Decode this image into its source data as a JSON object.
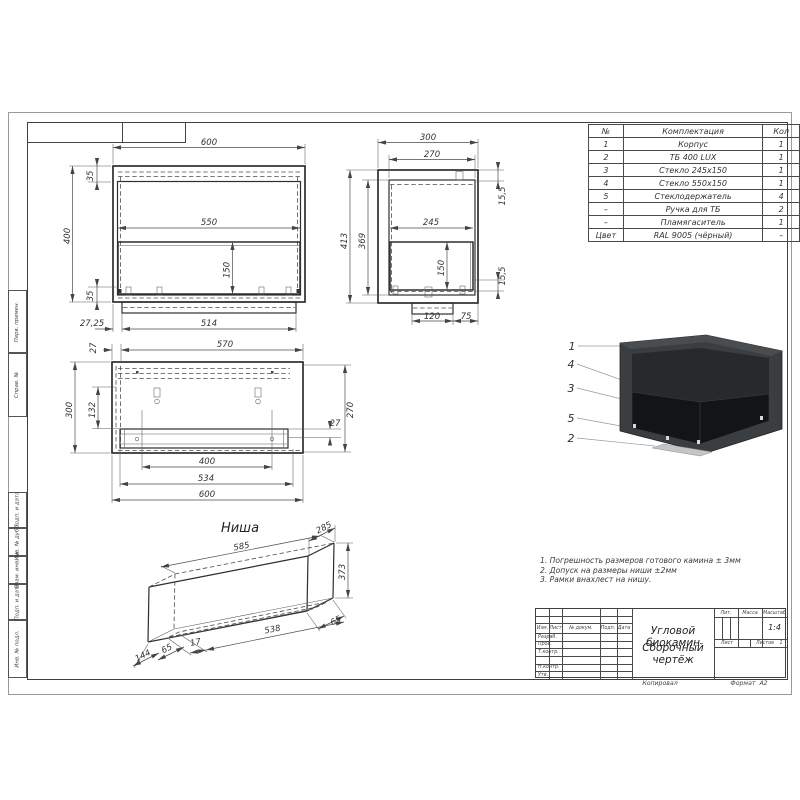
{
  "views": {
    "front": {
      "dim_width": "600",
      "dim_height": "400",
      "dim_top_inset": "35",
      "dim_bottom_inset": "35",
      "dim_glass_width": "550",
      "dim_glass_height": "150",
      "dim_base_offset": "27,25",
      "dim_base_width": "514"
    },
    "side": {
      "dim_width": "300",
      "dim_opening_width": "270",
      "dim_top_gap": "15,5",
      "dim_mid_width": "245",
      "dim_glass_height": "150",
      "dim_bottom_gap": "15,5",
      "dim_height_outer": "413",
      "dim_height_inner": "369",
      "dim_base_width": "120",
      "dim_base_offset": "75"
    },
    "plan": {
      "dim_top_width": "570",
      "dim_wall": "27",
      "dim_depth": "300",
      "dim_inner_depth": "132",
      "dim_opening_depth": "270",
      "dim_gap": "27",
      "dim_burner": "400",
      "dim_tray": "534",
      "dim_width": "600"
    },
    "niche": {
      "title": "Ниша",
      "dim_length": "585",
      "dim_depth": "285",
      "dim_height": "373",
      "dim_right_offset": "65",
      "dim_bottom_length": "538",
      "dim_small": "17",
      "dim_left_offset": "65",
      "dim_corner": "144"
    }
  },
  "callouts": [
    "1",
    "4",
    "3",
    "5",
    "2"
  ],
  "parts_table": {
    "headers": [
      "№",
      "Комплектация",
      "Кол"
    ],
    "rows": [
      [
        "1",
        "Корпус",
        "1"
      ],
      [
        "2",
        "ТБ 400 LUX",
        "1"
      ],
      [
        "3",
        "Стекло 245х150",
        "1"
      ],
      [
        "4",
        "Стекло 550х150",
        "1"
      ],
      [
        "5",
        "Стеклодержатель",
        "4"
      ],
      [
        "–",
        "Ручка для ТБ",
        "2"
      ],
      [
        "–",
        "Пламягаситель",
        "1"
      ],
      [
        "Цвет",
        "RAL 9005 (чёрный)",
        "–"
      ]
    ]
  },
  "notes": [
    "1. Погрешность размеров готового камина ± 3мм",
    "2. Допуск на размеры ниши ±2мм",
    "3. Рамки внахлест на нишу."
  ],
  "title_block": {
    "sig_headers": [
      "Изм.",
      "Лист",
      "№ докум.",
      "Подп.",
      "Дата"
    ],
    "sig_rows": [
      "Разраб.",
      "Пров.",
      "Т.контр.",
      "",
      "Н.контр.",
      "Утв."
    ],
    "doc_title_line1": "Угловой биокамин",
    "doc_title_line2": "Сборочный чертёж",
    "lit_label": "Лит.",
    "mass_label": "Масса",
    "scale_label": "Масштаб",
    "scale_value": "1:4",
    "sheet_label": "Лист",
    "sheets_label": "Листов",
    "sheets_value": "1",
    "copied_label": "Копировал",
    "format_label": "Формат",
    "format_value": "А2"
  },
  "margin_labels": [
    "Перв. примен.",
    "Справ. №",
    "Подп. и дата",
    "Инв. № дубл.",
    "Взам. инв. №",
    "Подп. и дата",
    "Инв. № подл."
  ],
  "render": {
    "body_color": "#3b3e41",
    "top_color": "#4a4d50",
    "cavity_color": "#27292b",
    "glass_color": "#131415",
    "base_color": "#c3c5c7"
  }
}
